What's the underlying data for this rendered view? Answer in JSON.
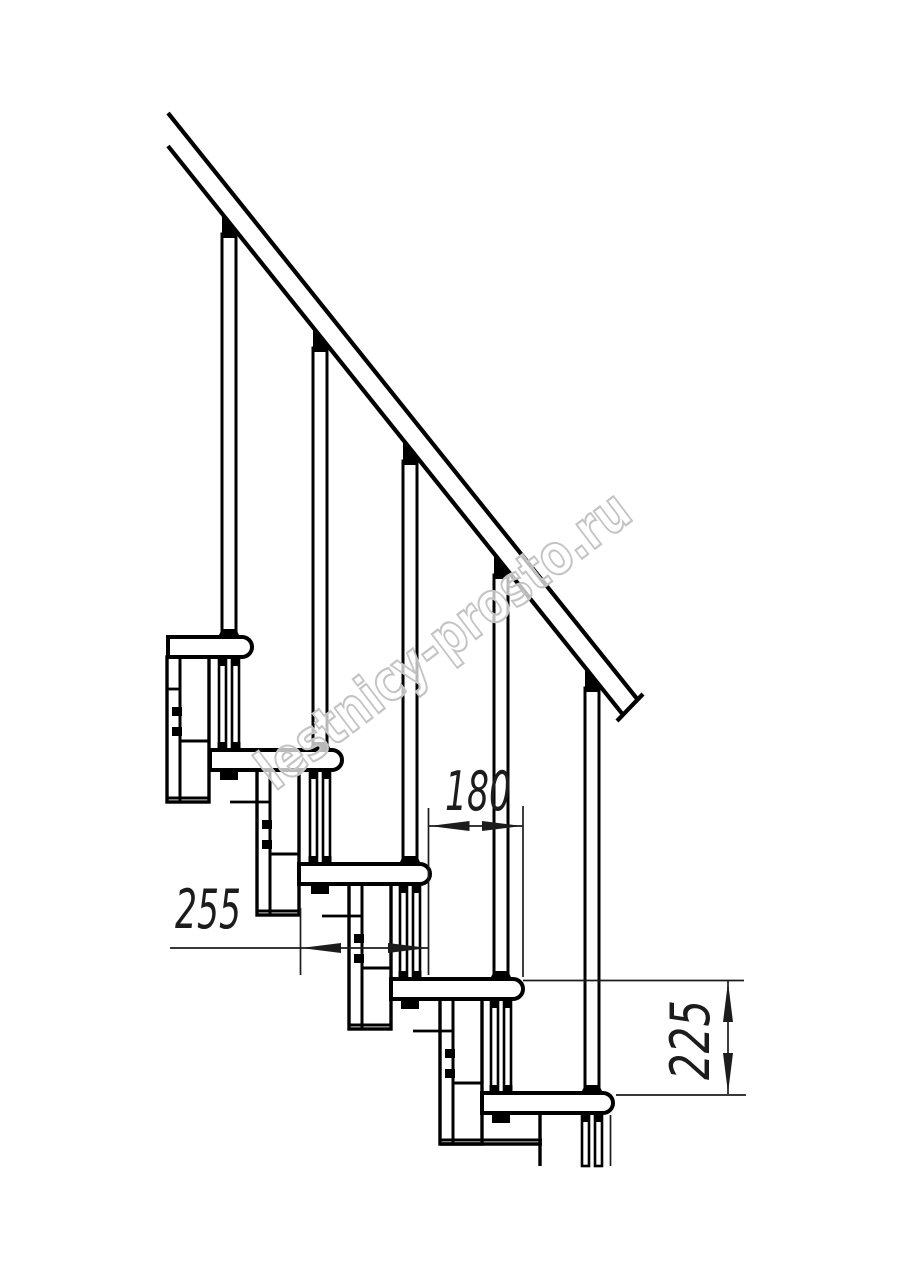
{
  "page": {
    "background": "#ffffff"
  },
  "watermark": {
    "text": "lestnicy-prosto.ru",
    "angle": -37.2,
    "cx": 455,
    "cy": 655,
    "font_size": 56,
    "length": 452,
    "fill": "#ffffff",
    "fill_opacity": 0.72,
    "outline_color": "#c4c4c4",
    "outline_width": 2.2
  },
  "drawing": {
    "ink": "#000000",
    "dim_ink": "#1c1c1c",
    "canvas": {
      "w": 914,
      "h": 1280
    },
    "rail": {
      "upper": [
        168,
        113,
        638,
        700
      ],
      "lower": [
        168,
        146,
        624,
        716
      ],
      "cap": [
        643,
        694,
        617,
        721
      ],
      "stroke": 4.2
    },
    "tread_thickness": 20,
    "nose_radius": 10,
    "treads": [
      {
        "left": 168,
        "nose": 252,
        "top": 637
      },
      {
        "left": 210,
        "nose": 342,
        "top": 750
      },
      {
        "left": 299,
        "nose": 430,
        "top": 864
      },
      {
        "left": 391,
        "nose": 523,
        "top": 979
      },
      {
        "left": 482,
        "nose": 613,
        "top": 1093
      }
    ],
    "balusters": [
      {
        "cx": 229,
        "rail_y": 222,
        "tread_top": 637
      },
      {
        "cx": 320,
        "rail_y": 336,
        "tread_top": 750
      },
      {
        "cx": 410,
        "rail_y": 449,
        "tread_top": 864
      },
      {
        "cx": 501,
        "rail_y": 563,
        "tread_top": 979
      },
      {
        "cx": 592,
        "rail_y": 676,
        "tread_top": 1093
      }
    ],
    "rods": [
      {
        "cx": 229,
        "from": 657,
        "to": 750,
        "cut": false
      },
      {
        "cx": 320,
        "from": 770,
        "to": 864,
        "cut": false
      },
      {
        "cx": 410,
        "from": 884,
        "to": 979,
        "cut": false
      },
      {
        "cx": 501,
        "from": 999,
        "to": 1093,
        "cut": false
      },
      {
        "cx": 592,
        "from": 1113,
        "to": 1166,
        "cut": true
      }
    ],
    "columns": [
      {
        "x": 167,
        "top": 657,
        "stub_from": 168,
        "wide_base": false
      },
      {
        "x": 257,
        "top": 770,
        "stub_from": 230,
        "wide_base": false
      },
      {
        "x": 349,
        "top": 884,
        "stub_from": 322,
        "wide_base": false
      },
      {
        "x": 440,
        "top": 999,
        "stub_from": 413,
        "wide_base": true
      }
    ],
    "column_spec": {
      "w": 42,
      "h": 145,
      "inner_dx": 13,
      "stub_dy": 32,
      "div_dy": 84,
      "bolt_dys": [
        50,
        70
      ]
    },
    "extra_lines": [
      [
        540,
        1113,
        540,
        1166
      ]
    ],
    "dimensions": [
      {
        "label": "180",
        "ext": [
          [
            428.5,
            808,
            428.5,
            975
          ],
          [
            523,
            806,
            523,
            977
          ]
        ],
        "line": [
          428.5,
          826,
          523,
          826
        ],
        "arrows": [
          {
            "tip": [
              429.5,
              826
            ],
            "deg": 180
          },
          {
            "tip": [
              522,
              826
            ],
            "deg": 0
          }
        ],
        "text": {
          "x": 445,
          "y": 810,
          "anchor": "start",
          "angle": 0,
          "size": 54,
          "length": 66
        }
      },
      {
        "label": "255",
        "ext": [
          [
            300.5,
            908,
            300.5,
            975
          ]
        ],
        "line": [
          170,
          948,
          428.5,
          948
        ],
        "arrows": [
          {
            "tip": [
              301,
              948
            ],
            "deg": 180
          },
          {
            "tip": [
              428,
              948
            ],
            "deg": 0
          }
        ],
        "text": {
          "x": 175,
          "y": 928,
          "anchor": "start",
          "angle": 0,
          "size": 54,
          "length": 66
        }
      },
      {
        "label": "225",
        "ext": [
          [
            523,
            980.5,
            744,
            980.5
          ],
          [
            616,
            1095,
            746,
            1095
          ]
        ],
        "line": [
          728,
          981,
          728,
          1094
        ],
        "arrows": [
          {
            "tip": [
              728,
              982
            ],
            "deg": -90
          },
          {
            "tip": [
              728,
              1093
            ],
            "deg": 90
          }
        ],
        "text": {
          "x": 709,
          "y": 1040,
          "anchor": "middle",
          "angle": -90,
          "size": 54,
          "length": 80
        },
        "extra": [
          [
            610.5,
            1115,
            610.5,
            1166
          ]
        ]
      }
    ]
  }
}
